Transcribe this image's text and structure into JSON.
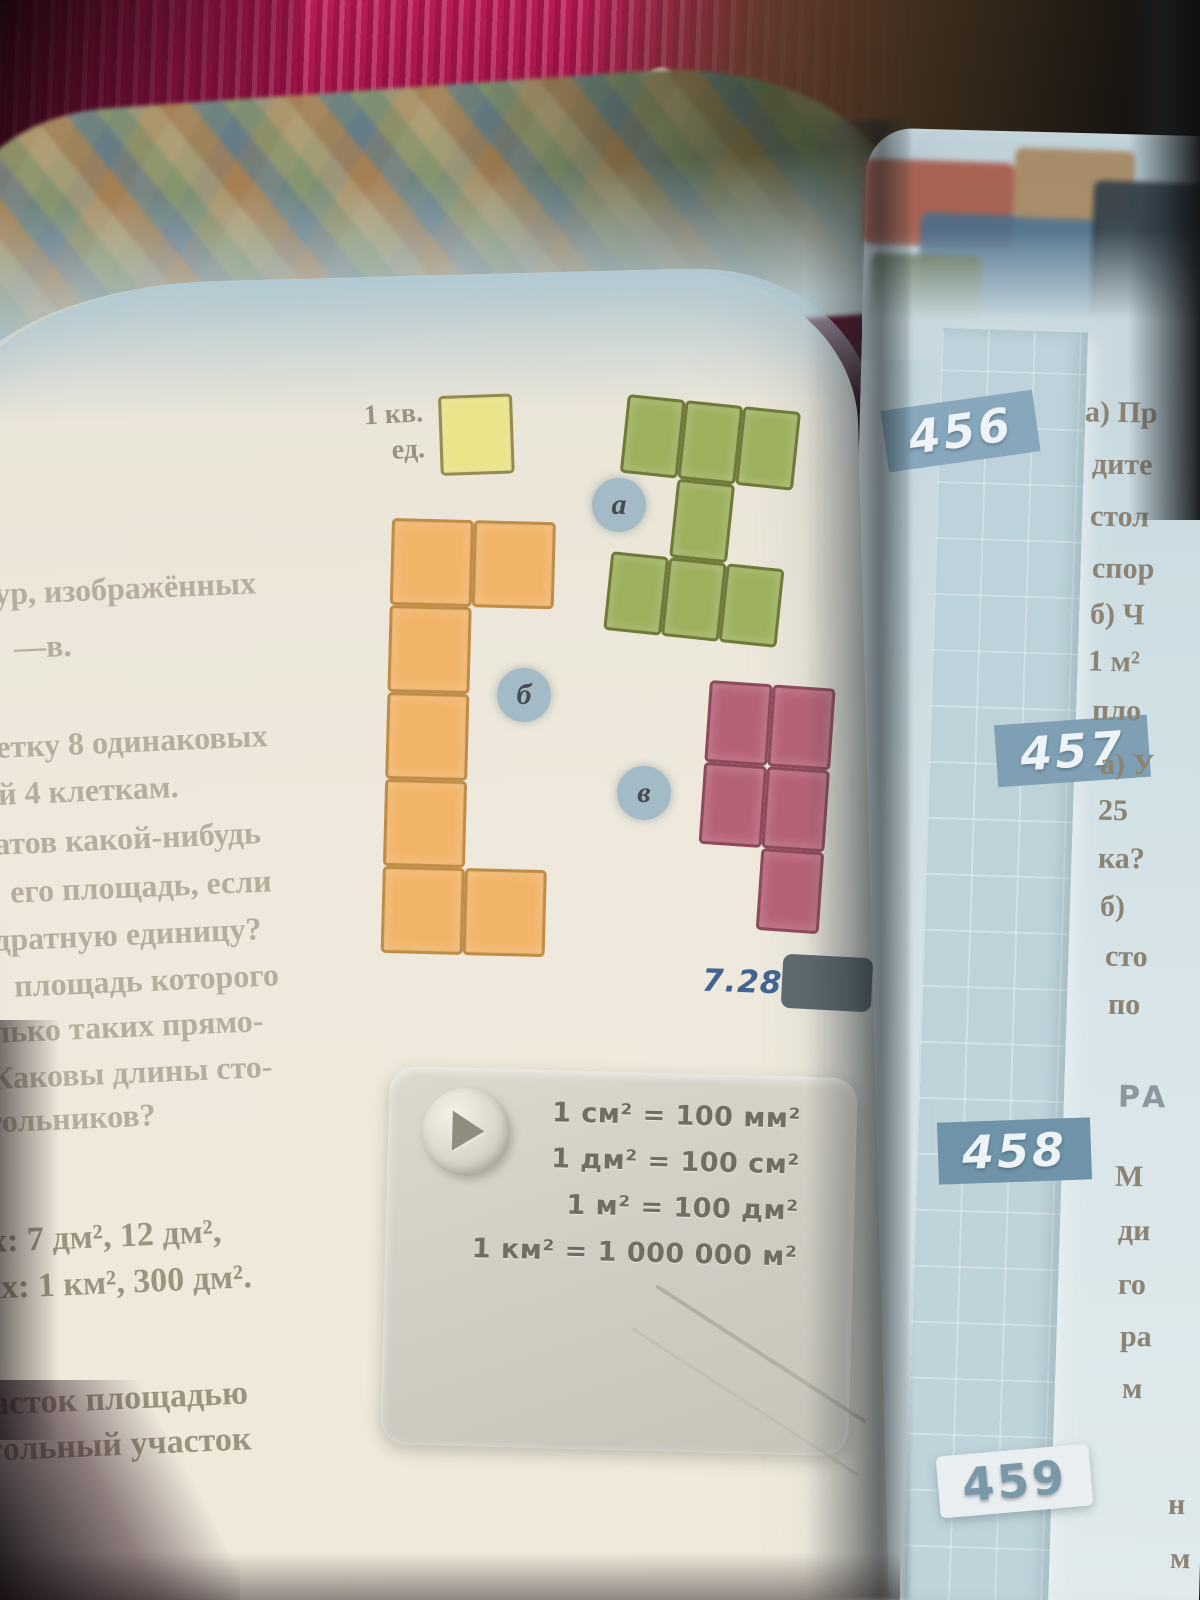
{
  "left_page": {
    "unit_label": {
      "line1": "1 кв.",
      "line2": "ед."
    },
    "figure_labels": {
      "a": "а",
      "b": "б",
      "v": "в"
    },
    "figures": [
      {
        "id": "unit",
        "color": "#e9e389",
        "border": "#948c4e",
        "cw": 74,
        "ch": 80,
        "cells": [
          [
            0,
            0
          ]
        ]
      },
      {
        "id": "a",
        "color": "#9db05c",
        "border": "#6e7a38",
        "cw": 58,
        "ch": 79,
        "cells": [
          [
            0,
            0
          ],
          [
            0,
            1
          ],
          [
            0,
            2
          ],
          [
            1,
            1
          ],
          [
            2,
            0
          ],
          [
            2,
            1
          ],
          [
            2,
            2
          ]
        ]
      },
      {
        "id": "b",
        "color": "#f2b469",
        "border": "#c08d46",
        "cw": 82,
        "ch": 87,
        "cells": [
          [
            0,
            0
          ],
          [
            0,
            1
          ],
          [
            1,
            0
          ],
          [
            2,
            0
          ],
          [
            3,
            0
          ],
          [
            4,
            0
          ],
          [
            4,
            1
          ]
        ]
      },
      {
        "id": "v",
        "color": "#b66276",
        "border": "#8e4a5a",
        "cw": 63,
        "ch": 82,
        "cells": [
          [
            0,
            0
          ],
          [
            0,
            1
          ],
          [
            1,
            0
          ],
          [
            1,
            1
          ],
          [
            2,
            1
          ]
        ]
      }
    ],
    "text_fragments": [
      "ур, изображённых",
      "—в.",
      "етку 8 одинаковых",
      "й 4 клеткам.",
      "атов какой-нибудь",
      "его площадь, если",
      "дратную единицу?",
      "площадь которого",
      "лько таких прямо-",
      "Каковы длины сто-",
      "гольников?",
      "х: 7 дм², 12 дм²,",
      "ах: 1 км², 300 дм².",
      "асток площадью",
      "гольный участок"
    ],
    "figure_ref": "7.28",
    "formula_box": {
      "icon": "play-icon",
      "lines": [
        "1 см² = 100 мм²",
        "1 дм² = 100 см²",
        "1 м² = 100 дм²",
        "1 км² = 1 000 000 м²"
      ]
    }
  },
  "right_page": {
    "problem_numbers": [
      "456",
      "457",
      "458",
      "459"
    ],
    "fragments_456": [
      "а) Пр",
      "дите",
      "стол",
      "спор",
      "б) Ч",
      "1 м²",
      "пло"
    ],
    "fragments_457": [
      "а) У",
      "25",
      "ка?",
      "б)",
      "сто",
      "по"
    ],
    "heading_fragment": "РА",
    "fragments_458": [
      "М",
      "ди",
      "го",
      "ра",
      "м"
    ],
    "fragments_459": [
      "н",
      "м"
    ]
  },
  "colors": {
    "badge_blue": "#7fa0b4",
    "page_left": "#ece7db",
    "page_right": "#cfdfe4",
    "fabric_crimson": "#a3154a",
    "unit_yellow": "#e9e389",
    "figure_green": "#9db05c",
    "figure_orange": "#f2b469",
    "figure_pink": "#b66276"
  }
}
